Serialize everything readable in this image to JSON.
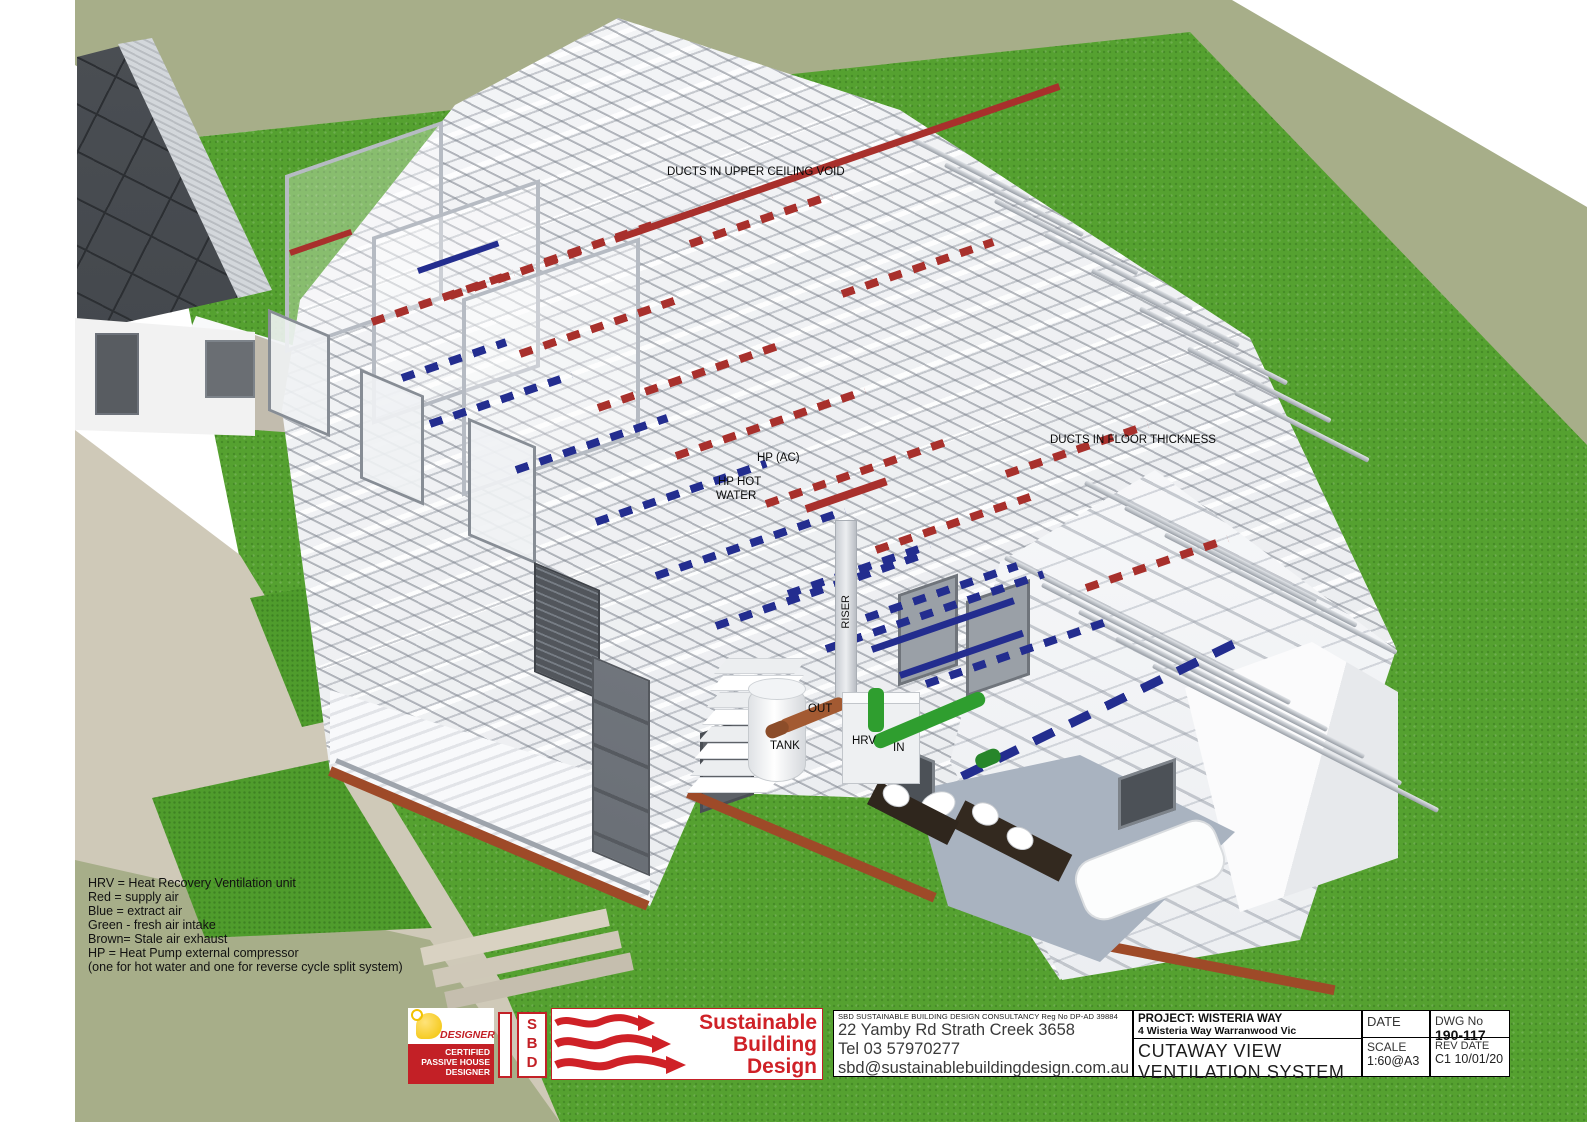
{
  "drawing": {
    "annotations": {
      "ducts_upper_ceiling": "DUCTS IN UPPER CEILING VOID",
      "ducts_floor": "DUCTS IN FLOOR THICKNESS",
      "hp_ac": "HP (AC)",
      "hp_hot_water_line1": "HP HOT",
      "hp_hot_water_line2": "WATER",
      "riser": "RISER",
      "out": "OUT",
      "tank": "TANK",
      "hrv": "HRV",
      "in": "IN"
    },
    "legend_lines": [
      "HRV = Heat Recovery Ventilation unit",
      "Red = supply air",
      "Blue = extract air",
      "Green - fresh air intake",
      "Brown= Stale air exhaust",
      "HP = Heat Pump external compressor",
      "(one for hot water and one for reverse cycle split system)"
    ],
    "colors": {
      "supply_air_red": "#A8302C",
      "extract_air_blue": "#232D8F",
      "fresh_air_green": "#2F9E2F",
      "stale_air_brown": "#A35A32",
      "lawn_green": "#55A130",
      "hill_sage": "#A7AE89",
      "path_beige": "#CFC9B8",
      "logo_red": "#C32026"
    }
  },
  "title_block": {
    "designer_badge": {
      "title": "DESIGNER",
      "lines": [
        "CERTIFIED",
        "PASSIVE HOUSE",
        "DESIGNER"
      ]
    },
    "sbd_monogram": [
      "S",
      "B",
      "D"
    ],
    "company": {
      "line1": "Sustainable",
      "line2": "Building",
      "line3": "Design"
    },
    "registration": "SBD SUSTAINABLE BUILDING DESIGN CONSULTANCY Reg No DP-AD 39884",
    "address": "22 Yamby Rd Strath Creek 3658",
    "phone": "Tel 03 57970277",
    "email": "sbd@sustainablebuildingdesign.com.au",
    "project_label": "PROJECT: WISTERIA WAY",
    "project_address": "4 Wisteria Way Warranwood Vic",
    "drawing_title_line1": "CUTAWAY VIEW",
    "drawing_title_line2": "VENTILATION SYSTEM",
    "date_label": "DATE",
    "scale_label": "SCALE",
    "scale_value": "1:60@A3",
    "dwg_label": "DWG No",
    "dwg_number": "190-117",
    "rev_label": "REV DATE",
    "rev_value": "C1 10/01/20"
  }
}
